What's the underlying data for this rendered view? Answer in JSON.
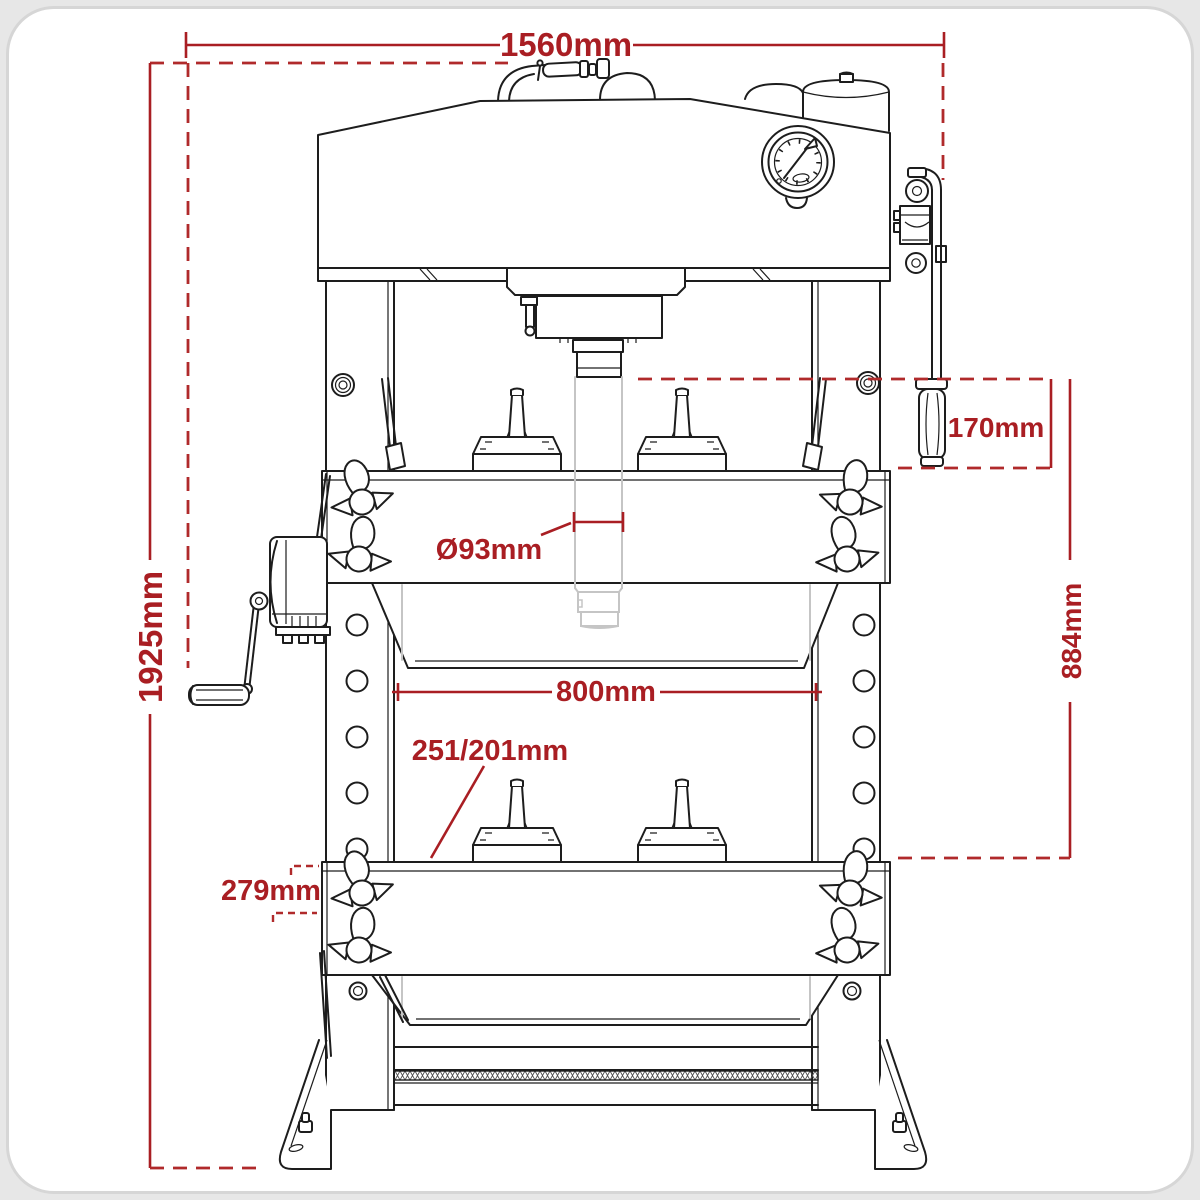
{
  "diagram": {
    "title": "hydraulic-press-front-view-dimension-drawing",
    "accent_color": "#a91e23",
    "line_color": "#1d1d1d",
    "phantom_color": "#c5c5c5",
    "dimensions": {
      "overall_width": "1560mm",
      "overall_height": "1925mm",
      "handle_length": "170mm",
      "bed_height": "884mm",
      "ram_diameter": "Ø93mm",
      "internal_width": "800mm",
      "block_spacing": "251/201mm",
      "base_depth": "279mm"
    }
  }
}
